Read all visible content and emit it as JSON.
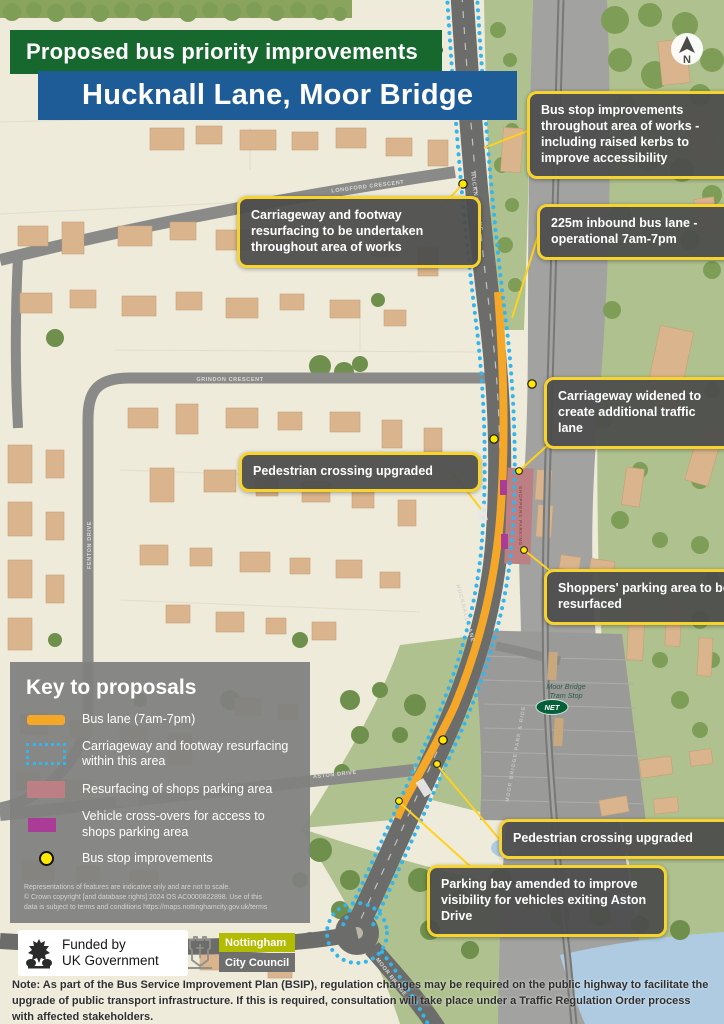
{
  "header": {
    "kicker": "Proposed bus priority improvements",
    "title": "Hucknall Lane, Moor Bridge"
  },
  "callouts": [
    {
      "text": "Bus stop improvements throughout area of works - including raised kerbs to improve accessibility"
    },
    {
      "text": "225m inbound bus lane - operational 7am-7pm"
    },
    {
      "text": "Carriageway and footway resurfacing to be undertaken throughout area of works"
    },
    {
      "text": "Carriageway widened to create additional traffic lane"
    },
    {
      "text": "Pedestrian crossing upgraded"
    },
    {
      "text": "Shoppers' parking area to be resurfaced"
    },
    {
      "text": "Pedestrian crossing upgraded"
    },
    {
      "text": "Parking bay amended to improve visibility for vehicles exiting Aston Drive"
    }
  ],
  "key": {
    "title": "Key to proposals",
    "items": [
      {
        "label": "Bus lane (7am-7pm)",
        "color": "#F5A728"
      },
      {
        "label": "Carriageway and footway resurfacing within this area",
        "color": "#35B5EA"
      },
      {
        "label": "Resurfacing of shops parking area",
        "color": "#BC8084"
      },
      {
        "label": "Vehicle cross-overs for access to shops parking area",
        "color": "#AA3C97"
      },
      {
        "label": "Bus stop improvements",
        "color": "#FFE800"
      }
    ],
    "disclaimer": [
      "Representations of features are indicative only and are not to scale.",
      "© Crown copyright [and database rights] 2024 OS AC0000822898. Use of this",
      "data is subject to terms and conditions  https://maps.nottinghamcity.gov.uk/terms"
    ]
  },
  "map": {
    "labels": {
      "longford": "LONGFORD CRESCENT",
      "grindon": "GRINDON CRESCENT",
      "fenton": "FENTON DRIVE",
      "aston": "ASTON DRIVE",
      "hucknall_top": "HUCKNALL LANE",
      "hucknall_mid": "HUCKNALL LANE",
      "moor_bridge": "MOOR BRIDGE",
      "park_ride": "MOOR BRIDGE PARK & RIDE",
      "tram_stop_1": "Moor Bridge",
      "tram_stop_2": "Tram Stop",
      "net": "NET",
      "shoppers": "SHOPPERS PARKING"
    },
    "north": "N"
  },
  "footer": {
    "funded_1": "Funded by",
    "funded_2": "UK Government",
    "council_1": "Nottingham",
    "council_2": "City Council"
  },
  "note": {
    "label": "Note:",
    "text": " As part of the Bus Service Improvement Plan (BSIP), regulation changes may be required on the public highway to facilitate the upgrade of public transport infrastructure. If this is required, consultation will take place under a Traffic Regulation Order process with affected stakeholders."
  },
  "colors": {
    "banner_green": "#17682E",
    "banner_blue": "#1E5C97",
    "callout_border": "#F6D32D",
    "bus_lane": "#F5A728",
    "resurfacing_outline": "#35B5EA",
    "shops_parking": "#BC8084",
    "crossovers": "#AA3C97",
    "bus_stop": "#FFE800"
  }
}
